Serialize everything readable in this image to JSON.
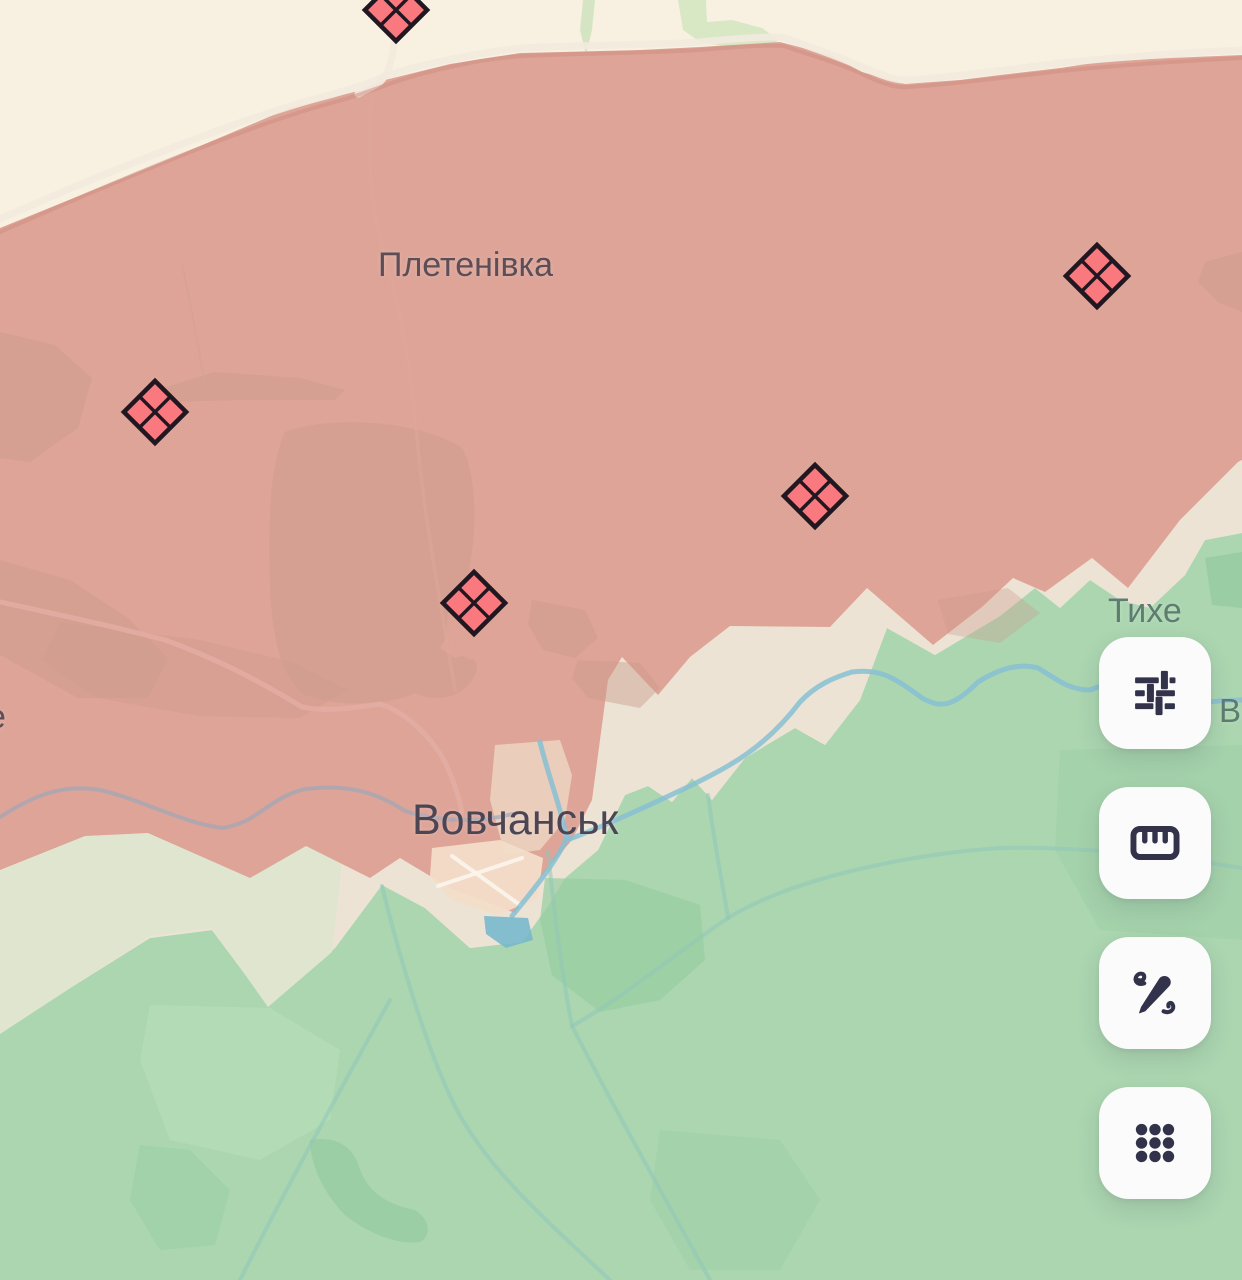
{
  "map": {
    "place_labels": [
      {
        "text": "Плетенівка"
      },
      {
        "text": "Вовчанськ"
      },
      {
        "text": "Тихе"
      },
      {
        "text": "е"
      },
      {
        "text": "Во"
      }
    ],
    "zones": {
      "neutral_top": "#f8f1e2",
      "occupied": "#dda497",
      "gray_zone": "#ece3d4",
      "gray_zone_sage": "#e0e5d0",
      "liberated": "#abd6b0"
    },
    "markers": {
      "symbol": "quartered-diamond",
      "fill": "#f9797f",
      "outline": "#201721",
      "count": 5
    }
  },
  "toolbar": {
    "background": "#fbfbfc",
    "icon_color": "#32334b",
    "buttons": [
      {
        "icon": "sliders-icon"
      },
      {
        "icon": "ruler-icon"
      },
      {
        "icon": "pen-scribble-icon"
      },
      {
        "icon": "dots-grid-icon"
      }
    ]
  }
}
